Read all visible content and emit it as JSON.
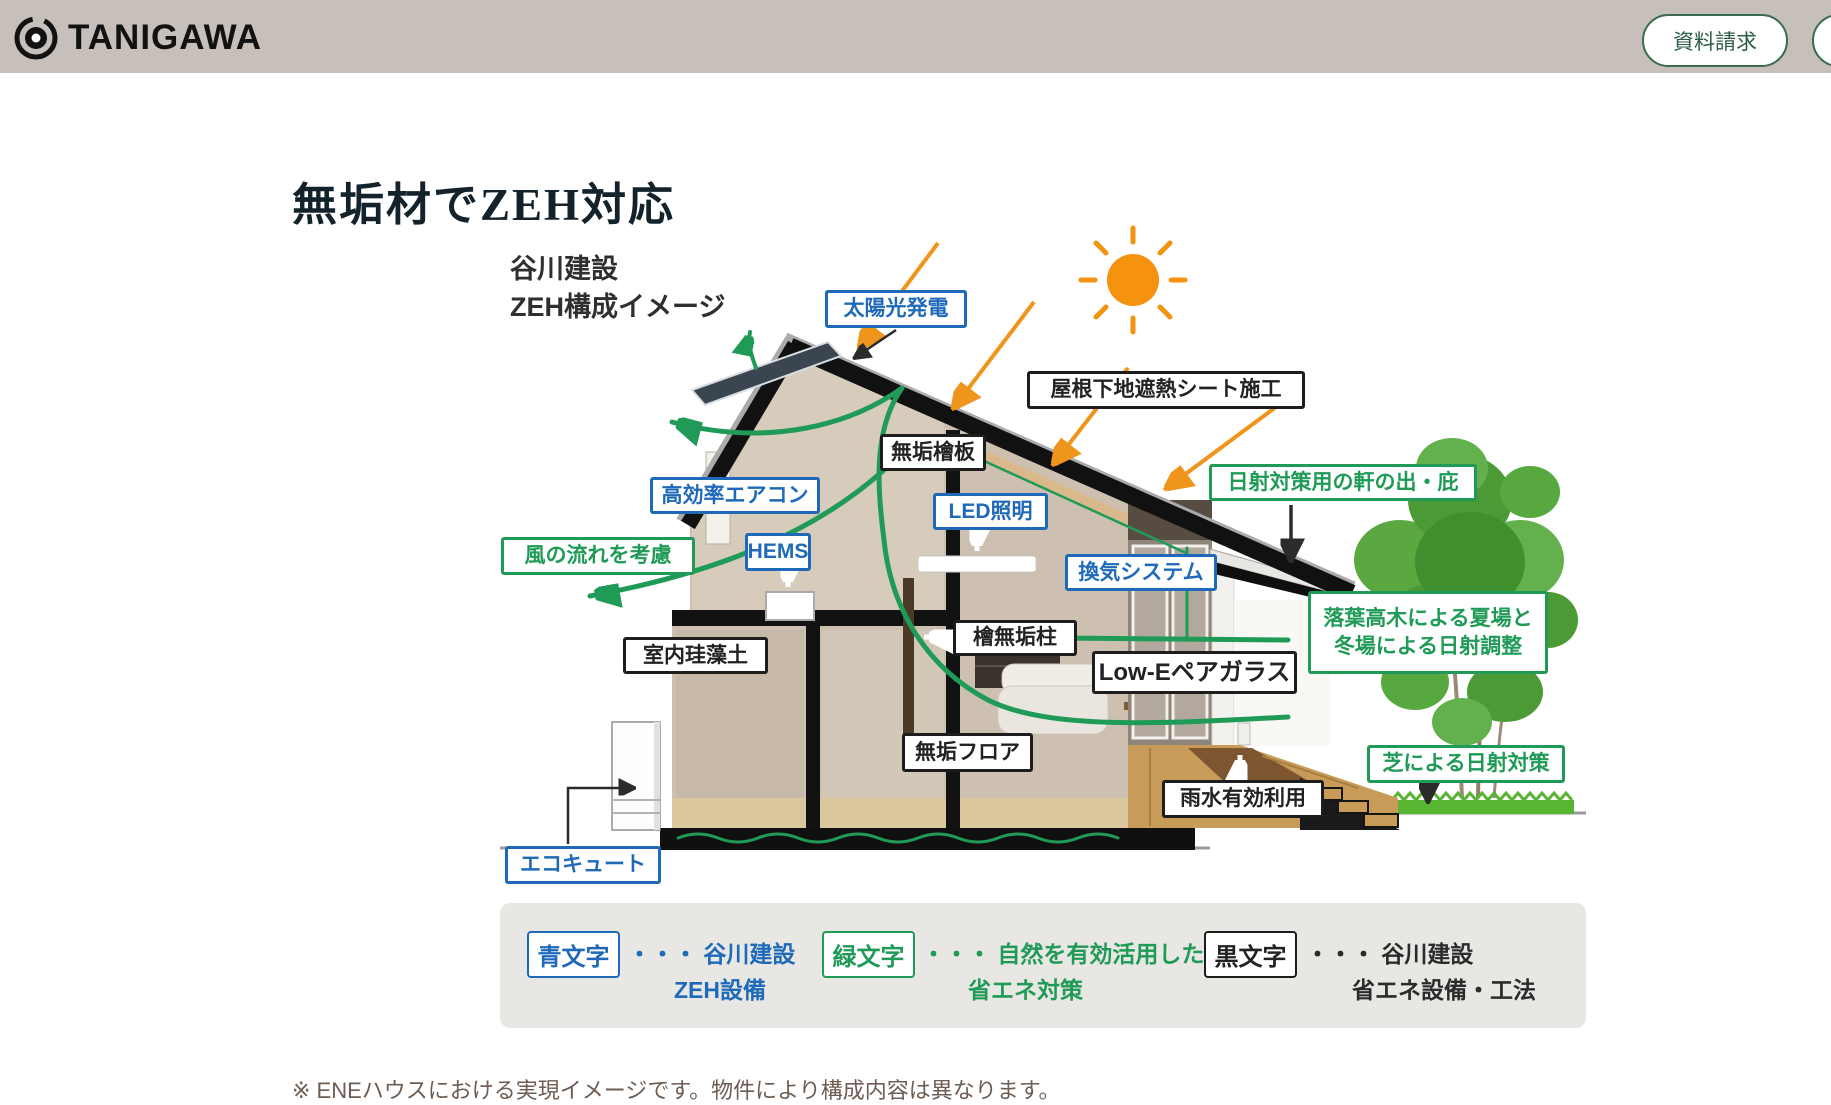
{
  "header": {
    "brand": "TANIGAWA",
    "request_button": "資料請求"
  },
  "page": {
    "title": "無垢材でZEH対応",
    "note": "※ ENEハウスにおける実現イメージです。物件により構成内容は異なります。"
  },
  "diagram": {
    "heading": "谷川建設\nZEH構成イメージ",
    "labels": [
      {
        "id": "solar",
        "color": "blue",
        "text": "太陽光発電"
      },
      {
        "id": "roof-sheet",
        "color": "black",
        "text": "屋根下地遮熱シート施工"
      },
      {
        "id": "hinoki-board",
        "color": "black",
        "text": "無垢檜板"
      },
      {
        "id": "aircon",
        "color": "blue",
        "text": "高効率エアコン"
      },
      {
        "id": "led",
        "color": "blue",
        "text": "LED照明"
      },
      {
        "id": "hems",
        "color": "blue",
        "text": "HEMS"
      },
      {
        "id": "wind-flow",
        "color": "green",
        "text": "風の流れを考慮"
      },
      {
        "id": "ventilation",
        "color": "blue",
        "text": "換気システム"
      },
      {
        "id": "eaves",
        "color": "green",
        "text": "日射対策用の軒の出・庇"
      },
      {
        "id": "diatomite",
        "color": "black",
        "text": "室内珪藻土"
      },
      {
        "id": "hinoki-pillar",
        "color": "black",
        "text": "檜無垢柱"
      },
      {
        "id": "low-e-glass",
        "color": "black",
        "text": "Low-Eペアガラス"
      },
      {
        "id": "trees",
        "color": "green",
        "text": "落葉高木による夏場と\n冬場による日射調整"
      },
      {
        "id": "muku-floor",
        "color": "black",
        "text": "無垢フロア"
      },
      {
        "id": "rainwater",
        "color": "black",
        "text": "雨水有効利用"
      },
      {
        "id": "lawn",
        "color": "green",
        "text": "芝による日射対策"
      },
      {
        "id": "ecocute",
        "color": "blue",
        "text": "エコキュート"
      }
    ]
  },
  "legend": {
    "items": [
      {
        "key": "青文字",
        "color": "blue",
        "line1": "・・・ 谷川建設",
        "line2": "ZEH設備"
      },
      {
        "key": "緑文字",
        "color": "green",
        "line1": "・・・ 自然を有効活用した",
        "line2": "省エネ対策"
      },
      {
        "key": "黒文字",
        "color": "black",
        "line1": "・・・ 谷川建設",
        "line2": "省エネ設備・工法"
      }
    ]
  },
  "colors": {
    "accent_blue": "#1f6ab8",
    "accent_green": "#1f9b57",
    "label_black": "#1d1d1d",
    "header_bg": "#c7c0ba",
    "sun_orange": "#f5920f",
    "button_green": "#2c5c42"
  }
}
